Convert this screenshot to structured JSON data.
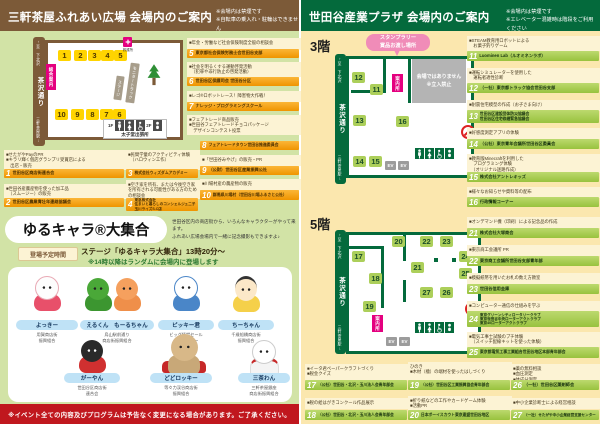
{
  "road": {
    "name": "茶沢通り",
    "top": "↑至 下北沢",
    "bottom": "三軒茶屋駅↓"
  },
  "left": {
    "header": {
      "title": "三軒茶屋ふれあい広場 会場内のご案内",
      "notes": "※会場内は禁煙です\n※自転車の乗入れ・駐輪はできません"
    },
    "map": {
      "info": "総合案内",
      "aid": "救護所",
      "stage": "ステージ",
      "truck": "モニタートラック",
      "f1": "1F",
      "f2": "2F",
      "fac": "太子堂出張所",
      "top_booths": [
        "1",
        "2",
        "3",
        "4",
        "5"
      ],
      "bottom_booths": [
        "10",
        "9",
        "8",
        "7",
        "6"
      ]
    },
    "booths": [
      {
        "num": "1",
        "org": "世田谷区商店街連合会",
        "desc": "■せたがやPayのPR\n■キラリ輝く個店グランプリ受賞店による\n　出店・販売"
      },
      {
        "num": "2",
        "org": "世田谷区農業青壮年連絡協議会",
        "desc": "■世田谷産農産物を使った加工品\n　（スムージー）の販売"
      },
      {
        "num": "3",
        "org": "株式会社ウィズダムアカデミー",
        "desc": "■民間学童のアクティビティ体験\n　（ハロウィン工作）"
      },
      {
        "num": "4",
        "org": "東急株式会社\n住まいと暮らしのコンシェルジュ二子玉川ライズS.C店",
        "desc": "■空き家を所有、または今後空き家を所有される可能性がある方のための相談会"
      },
      {
        "num": "5",
        "org": "東京都社会保険労務士会世田谷支部",
        "desc": "■年金・労働など社会保険制度全般の相談会"
      },
      {
        "num": "6",
        "org": "世田谷区保護司会 世田谷分区",
        "desc": "■社会を明るくする運動啓発活動\n　（犯罪や非行防止の啓発活動）"
      },
      {
        "num": "7",
        "org": "ナレッジ・プログラミングスクール",
        "desc": "■レゴ®ロボットレース！障害物大作戦！"
      },
      {
        "num": "8",
        "org": "フェアトレードタウン世田谷推進委員会",
        "desc": "■フェアトレード商品販売\n■世田谷フェアトレードチョコパッケージ\n　デザインコンテスト投票"
      },
      {
        "num": "9",
        "org": "（公財）世田谷区産業振興公社",
        "desc": "■「世田谷みやげ」の販売・PR"
      },
      {
        "num": "10",
        "org": "群馬県川場村（世田谷川場ふるさと公社）",
        "desc": "■川場村産の農産物の販売"
      }
    ],
    "mascot": {
      "title": "ゆるキャラ®大集合",
      "lead": "世田谷区内の商店街から、いろんなキャラクターがやって来ます。\nふれあい広場会場内で一緒に記念撮影もできますよ♪",
      "time_label": "登場予定時間",
      "time1": "ステージ「ゆるキャラ大集合」13時20分～",
      "time2": "※14時以降はランダムに会場内に登場します",
      "chars": [
        {
          "name": "よっきー",
          "org": "用賀商店街\n振興組合"
        },
        {
          "name": "えるくん　もーるちゃん",
          "org": "烏山駅前通り\n商店街振興組合"
        },
        {
          "name": "ピッキー君",
          "org": "ビッグ経堂セール\nキャラクター"
        },
        {
          "name": "ちーちゃん",
          "org": "千歳船橋商店街\n振興組合"
        },
        {
          "name": "がーやん",
          "org": "世田谷区商店街\n連合会"
        },
        {
          "name": "どどロッキー",
          "org": "等々力渓谷商店街\n振興組合"
        },
        {
          "name": "三茶わん",
          "org": "三軒茶屋銀座\n商店街振興組合"
        }
      ]
    },
    "footer": "※イベント全ての内容及びプログラムは予告なく変更になる場合があります。ご了承ください。"
  },
  "right": {
    "header": {
      "title": "世田谷産業プラザ 会場内のご案内",
      "notes": "※会場内は禁煙です\n※エレベーター混雑時は階段をご利用ください"
    },
    "ev": "EV",
    "f3": {
      "label": "3階",
      "bubble": "スタンプラリー\n賞品お渡し場所",
      "info": "案内所",
      "closed": "会場ではありません\n※立入禁止",
      "booths": [
        "12",
        "11",
        "13",
        "16",
        "14",
        "15"
      ]
    },
    "f5": {
      "label": "5階",
      "info": "案内所",
      "booths": [
        "20",
        "22",
        "23",
        "24",
        "17",
        "18",
        "21",
        "19",
        "27",
        "26",
        "25"
      ]
    },
    "booths": [
      {
        "num": "11",
        "org": "Luominen Lab（ルオミネンラボ）",
        "desc": "■STEAM教育用ロボットによる\n　お菓子釣りゲーム"
      },
      {
        "num": "12",
        "org": "（一社）東京都トラック協会世田谷支部",
        "desc": "■運転シミュレーターを使用した\n　運転者適性診断"
      },
      {
        "num": "13",
        "org": "世田谷区建設団体防災協議会\n世田谷区住宅修繕緊急協議会",
        "desc": "■耐震住宅模型の作成（お子さま向け）"
      },
      {
        "num": "14",
        "org": "（公社）東京青年会議所世田谷区委員会",
        "desc": "■好感度測定アプリの体験"
      },
      {
        "num": "15",
        "org": "株式会社アントレキッズ",
        "desc": "■教育版Minecraftを利用した\n　プログラミング体験\n　（オリジナル迷路作成）"
      },
      {
        "num": "16",
        "org": "行政情報コーナー",
        "desc": "■様々なお知らせや資料等の配布"
      },
      {
        "num": "21",
        "org": "株式会社大塚商会",
        "desc": "■オンデマンド機（印刷）による記念品の作成"
      },
      {
        "num": "22",
        "org": "東京商工会議所世田谷支部青年部",
        "desc": "■東京商工会議所 PR"
      },
      {
        "num": "23",
        "org": "世田谷信用金庫",
        "desc": "■模擬紙幣を用いたお札の数え方教室"
      },
      {
        "num": "24",
        "org": "東京グリーンシティロータリークラブ\n東京世田谷中央ローターアクトクラブ\n東京40ローターアクトクラブ",
        "desc": "■コンピューター通信の仕組みを学ぶ"
      },
      {
        "num": "25",
        "org": "東京都電気工事工業組合世田谷地区本部青年部会",
        "desc": "■電気工事士試験のプチ体験\n　（スイッチ配線キットを使った体験）"
      },
      {
        "num": "17",
        "org": "（公社）世田谷・北沢・玉川法人会青年部会",
        "desc": "■イータ君ペーパークラフトづくり\n■税金クイズ"
      },
      {
        "num": "18",
        "org": "（公社）世田谷・北沢・玉川法人会青年部会",
        "desc": "■税の絵はがきコンクール作品展示"
      },
      {
        "num": "19",
        "org": "（公社）世田谷区工業振興協会青年部会",
        "desc": "ひのき\n■木材（檜）の端材を使ったはしづくり"
      },
      {
        "num": "20",
        "org": "日本ボーイスカウト東京連盟世田谷地区",
        "desc": "■折り紙などの工作やカードゲーム体験\n■活動PR"
      },
      {
        "num": "26",
        "org": "（一社）世田谷区薬剤師会",
        "desc": "■薬の無料相談\n■血圧測定\n■体成分測定"
      },
      {
        "num": "27",
        "org": "（一社）せたがや中小企業経営支援センター",
        "desc": "■中小企業診断士による経営相談"
      }
    ]
  }
}
